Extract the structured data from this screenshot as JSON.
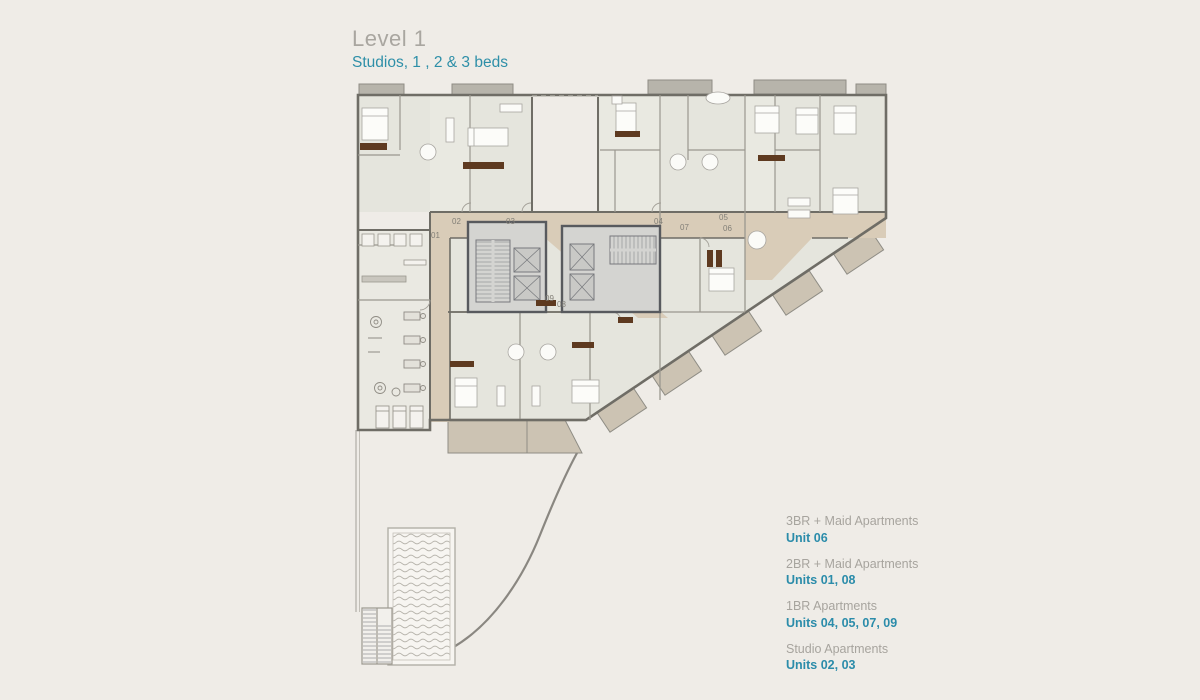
{
  "header": {
    "title": "Level 1",
    "subtitle": "Studios, 1 , 2 & 3 beds"
  },
  "legend": [
    {
      "label": "3BR + Maid Apartments",
      "units": "Unit 06"
    },
    {
      "label": "2BR + Maid Apartments",
      "units": "Units 01, 08"
    },
    {
      "label": "1BR Apartments",
      "units": "Units 04, 05, 07, 09"
    },
    {
      "label": "Studio Apartments",
      "units": "Units 02, 03"
    }
  ],
  "plan": {
    "unit_labels": [
      {
        "text": "01"
      },
      {
        "text": "02"
      },
      {
        "text": "03"
      },
      {
        "text": "04"
      },
      {
        "text": "05"
      },
      {
        "text": "06"
      },
      {
        "text": "07"
      },
      {
        "text": "08"
      },
      {
        "text": "09"
      }
    ]
  },
  "colors": {
    "background": "#efece7",
    "floor": "#e5e5dd",
    "corridor_tan": "#d9ccb8",
    "terrace_tan": "#ccc3b3",
    "wall_gray": "#6f6d66",
    "core_gray": "#d4d4d1",
    "furniture_brown": "#5e3a20",
    "accent_teal": "#2b8caa",
    "title_gray": "#a9a6a0"
  }
}
